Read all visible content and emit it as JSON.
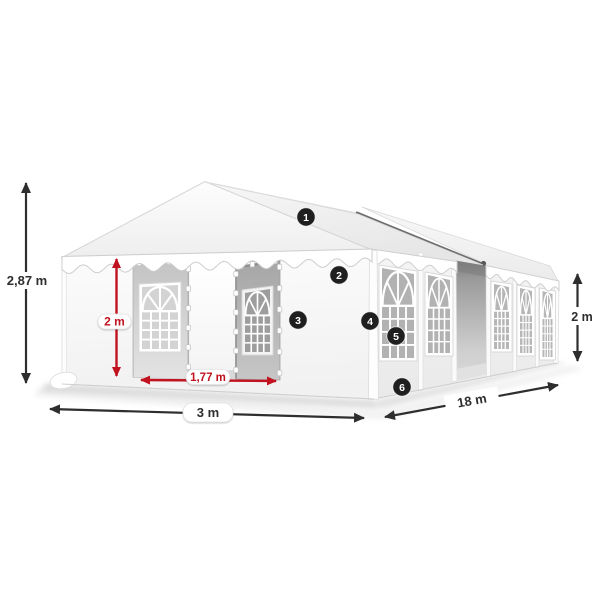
{
  "image": {
    "subject": "White party tent (marquee) dimensional diagram with numbered feature callouts",
    "background": "#ffffff"
  },
  "dimensions": {
    "total_height": {
      "label": "2,87 m",
      "color": "#2e2e2e",
      "location": "left vertical"
    },
    "wall_height_front": {
      "label": "2 m",
      "color": "#c1121f",
      "location": "front entrance vertical"
    },
    "door_width": {
      "label": "1,77 m",
      "color": "#c1121f",
      "location": "front entrance horizontal"
    },
    "front_width": {
      "label": "3 m",
      "color": "#2e2e2e",
      "location": "front bottom horizontal"
    },
    "side_length": {
      "label": "18 m",
      "color": "#2e2e2e",
      "location": "side bottom diagonal"
    },
    "wall_height_rear": {
      "label": "2 m",
      "color": "#2e2e2e",
      "location": "right vertical"
    }
  },
  "callouts": [
    {
      "number": "1",
      "target": "roof tarpaulin"
    },
    {
      "number": "2",
      "target": "valance / gable wall"
    },
    {
      "number": "3",
      "target": "front wall panel"
    },
    {
      "number": "4",
      "target": "corner post"
    },
    {
      "number": "5",
      "target": "side window panel"
    },
    {
      "number": "6",
      "target": "side wall base"
    }
  ],
  "colors": {
    "accent_red": "#c1121f",
    "dimension_text": "#2e2e2e",
    "callout_background": "#1f1f1f",
    "callout_text": "#ffffff",
    "fabric": "#ffffff",
    "fabric_shadow": "#e9e9e9",
    "window_pane": "#b2b2b2",
    "ridge_connector": "#6d6d6d"
  }
}
